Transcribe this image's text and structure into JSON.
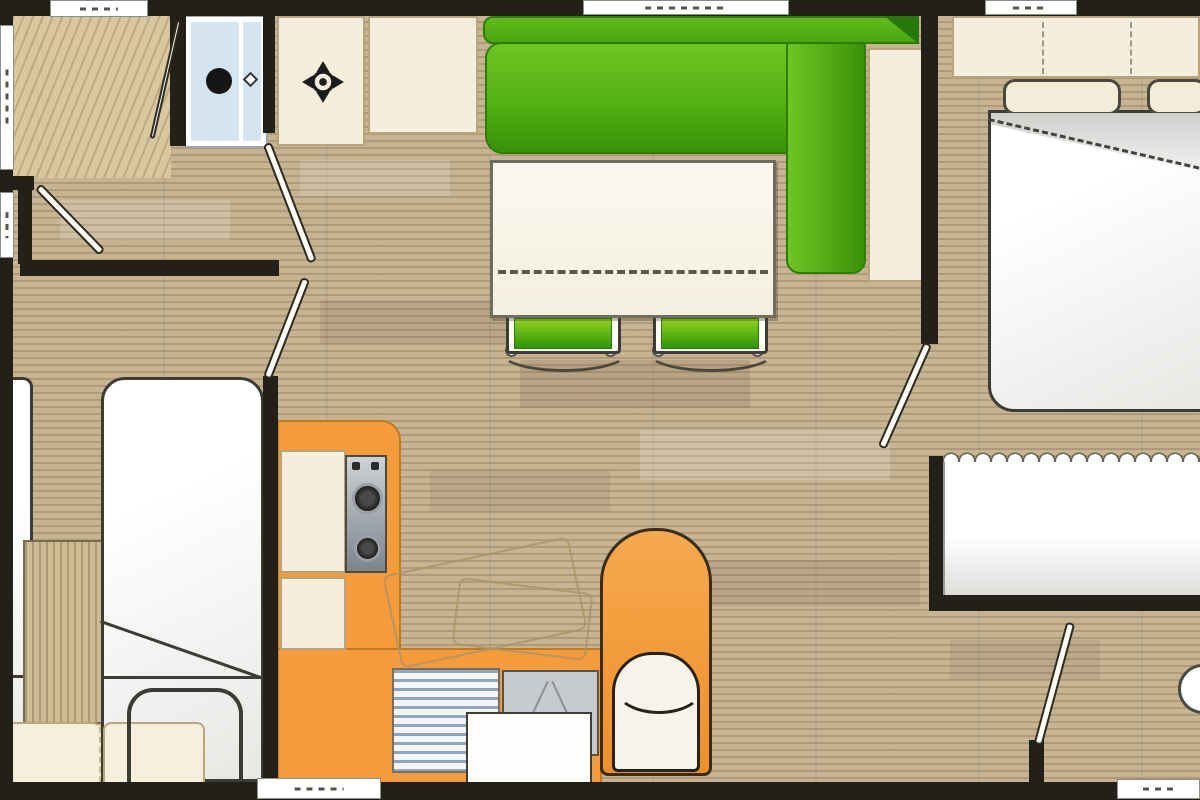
{
  "plan": {
    "type": "mobile-home floor plan, top-down view",
    "visible_text": [],
    "palette": {
      "wall": "#23201a",
      "floor_wood": "#c6b493",
      "floor_light": "#d9c79f",
      "sofa_green": "#54b013",
      "sofa_green_dark": "#2f8c0a",
      "chair_green": "#3fae10",
      "kitchen_orange": "#f49c3c",
      "furniture_cream": "#f5eedb",
      "shower_blue": "#d4e5f1",
      "bed_white": "#ffffff",
      "stainless": "#9aa0a6"
    },
    "rooms": {
      "bathroom": "bathroom",
      "living_dining": "living-dining area",
      "kitchen": "kitchen corner",
      "bedroom_left": "twin bedroom",
      "bedroom_right": "master bedroom",
      "rear_room": "rear washroom"
    },
    "items": {
      "wall": "wall",
      "window": "window",
      "door": "door leaf",
      "floor": "wood-plank floor",
      "shower": "shower cubicle",
      "shower_glass": "shower glass door",
      "shower_drain": "shower drain",
      "shower_handle": "door handle",
      "vanity": "washbasin vanity unit",
      "faucet": "tap / basin symbol",
      "sofa": "L-shaped green sofa",
      "sofa_back": "sofa backrest",
      "sideboard": "sideboard cabinet",
      "table": "dining table with fold line",
      "chair": "dining chair",
      "counter": "kitchen counter",
      "hob": "two-burner hob",
      "cabinet": "kitchen cabinet",
      "drainer": "drainer vent",
      "sink": "kitchen sink",
      "worktop": "worktop block",
      "stored_chair": "folded chair outline",
      "armchair": "orange armchair",
      "seat_cushion": "seat cushion",
      "single_bed": "single bed",
      "bed_fold": "blanket fold line",
      "bed_frame": "bed frame outline",
      "pillow": "pillow",
      "bedside_unit": "bedside wood unit",
      "double_bed": "double bed",
      "duvet_fold": "folded duvet",
      "headboard": "headboard cabinet",
      "closet": "wardrobe with scalloped front",
      "washbasin": "round washbasin"
    }
  }
}
